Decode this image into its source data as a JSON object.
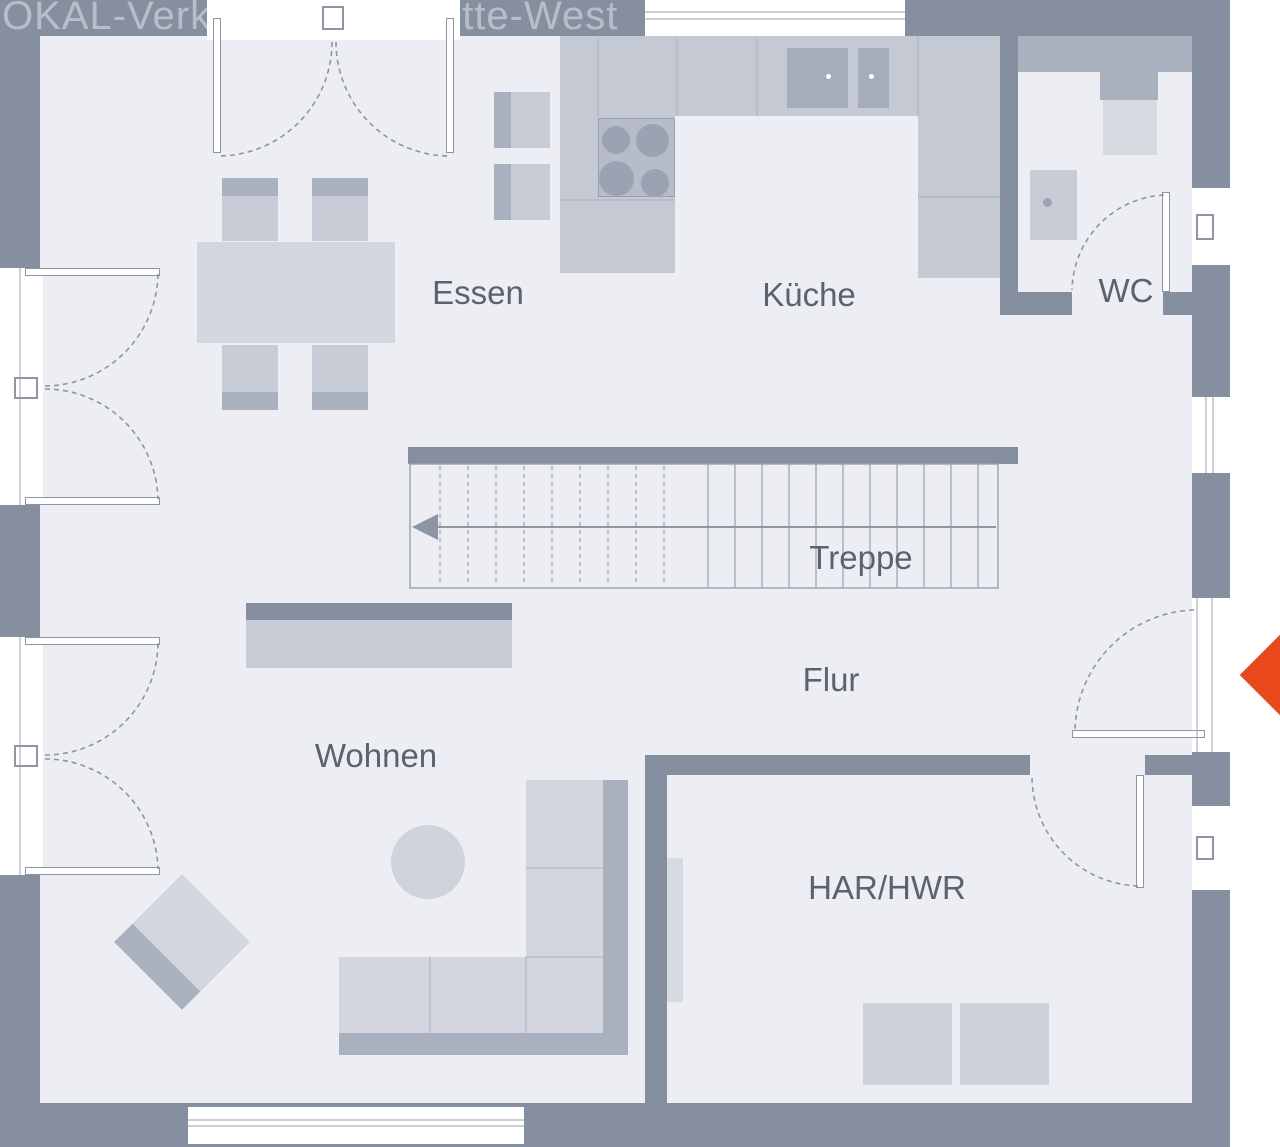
{
  "watermark": {
    "left": "OKAL-Verk",
    "right": "Mitte-West"
  },
  "rooms": {
    "essen": {
      "label": "Essen"
    },
    "kueche": {
      "label": "Küche"
    },
    "wc": {
      "label": "WC"
    },
    "treppe": {
      "label": "Treppe"
    },
    "flur": {
      "label": "Flur"
    },
    "wohnen": {
      "label": "Wohnen"
    },
    "har_hwr": {
      "label": "HAR/HWR"
    }
  },
  "colors": {
    "outside": "#FFFFFF",
    "wall": "#868F9F",
    "floor": "#ECEEF3",
    "furniture_light": "#D3D6DE",
    "furniture_mid": "#C7CCD6",
    "furniture_dark": "#A9B0BE",
    "counter": "#C4C9D4",
    "cooktop": "#B6BCC8",
    "burner": "#9BA3B2",
    "sink": "#A5ACBA",
    "appliance": "#CDD1DA",
    "fixture_light": "#D6DAE1",
    "stroke": "#8D95A3",
    "label_text": "#5A6270",
    "entrance_arrow": "#E8481B"
  },
  "entrance_marker": {
    "direction": "left"
  }
}
